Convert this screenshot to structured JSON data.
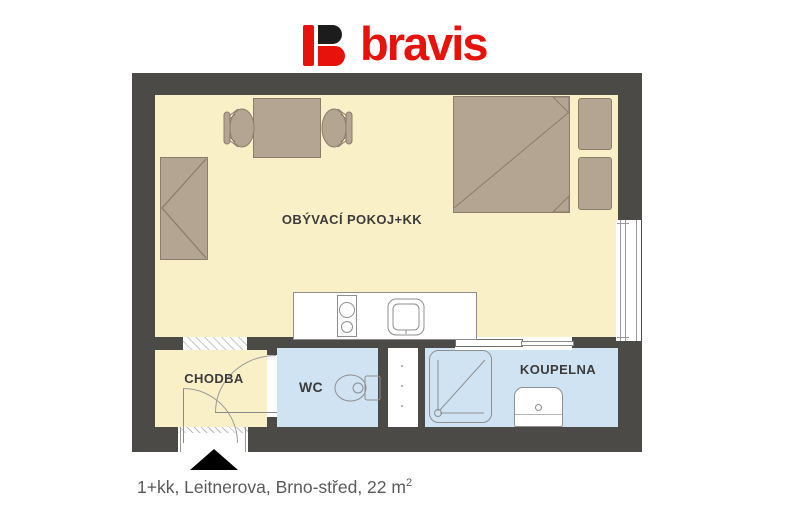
{
  "brand": {
    "name": "bravis",
    "logo_red": "#e8120c",
    "logo_black": "#1c1c1c"
  },
  "floor_plan": {
    "rooms": [
      {
        "id": "living",
        "label": "OBÝVACÍ POKOJ+KK"
      },
      {
        "id": "hall",
        "label": "CHODBA"
      },
      {
        "id": "wc",
        "label": "WC"
      },
      {
        "id": "bathroom",
        "label": "KOUPELNA"
      }
    ],
    "fixtures": [
      "wardrobe",
      "dining-table",
      "chair",
      "chair",
      "double-bed",
      "pillow",
      "pillow",
      "kitchen-counter",
      "cooktop",
      "kitchen-sink",
      "toilet",
      "shower",
      "washbasin",
      "window",
      "entrance-door",
      "interior-door",
      "sliding-door",
      "entrance-arrow"
    ],
    "colors": {
      "wall": "#4b4a47",
      "floor": "#faf0c8",
      "wet_room": "#cfe3f3",
      "furniture": "#b4a593",
      "furniture_outline": "#8a7d6b",
      "fixture_outline": "#8f8f8f",
      "entrance_marker": "#000000"
    }
  },
  "caption": {
    "text": "1+kk, Leitnerova, Brno-střed, 22 m",
    "superscript": "2"
  }
}
